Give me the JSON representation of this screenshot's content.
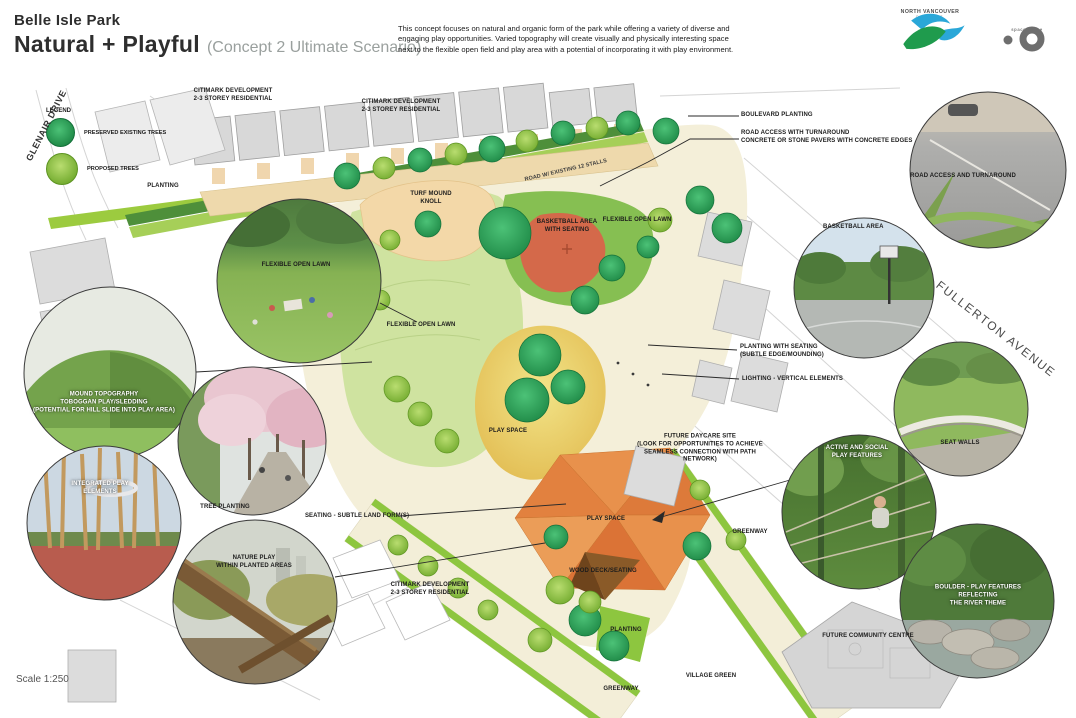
{
  "header": {
    "park_name": "Belle Isle Park",
    "concept_title": "Natural + Playful",
    "concept_subtitle": "(Concept 2 Ultimate Scenario)",
    "description": "This concept focuses on natural and organic form of the park while offering a variety of diverse and engaging play opportunities.  Varied topography will create visually and physically interesting space next to the flexible open field and play area with a potential of incorporating it with play environment.",
    "logo_nv": {
      "line1": "NORTH VANCOUVER",
      "line2": "DISTRICT"
    },
    "logo_firm": {
      "text": "space2place"
    }
  },
  "legend": {
    "title": "LEGEND",
    "items": [
      {
        "label": "PRESERVED EXISTING TREES",
        "color": "#2fa360"
      },
      {
        "label": "PROPOSED TREES",
        "color": "#8dc63f"
      }
    ]
  },
  "streets": {
    "glenair": "GLENAIR DRIVE",
    "fullerton": "FULLERTON AVENUE"
  },
  "scale_label": "Scale 1:250",
  "map_labels": [
    {
      "text": "CITIMARK DEVELOPMENT\n2-3 STOREY RESIDENTIAL"
    },
    {
      "text": "CITIMARK DEVELOPMENT\n2-3 STOREY RESIDENTIAL"
    },
    {
      "text": "PLANTING"
    },
    {
      "text": "TURF MOUND\nKNOLL"
    },
    {
      "text": "ROAD W/ EXISTING 12 STALLS"
    },
    {
      "text": "BASKETBALL AREA\nWITH SEATING"
    },
    {
      "text": "FLEXIBLE OPEN LAWN"
    },
    {
      "text": "FLEXIBLE OPEN LAWN"
    },
    {
      "text": "PLAY SPACE"
    },
    {
      "text": "SEATING - SUBTLE LAND FORM(S)"
    },
    {
      "text": "PLAY SPACE"
    },
    {
      "text": "WOOD DECK/SEATING"
    },
    {
      "text": "GREENWAY"
    },
    {
      "text": "CITIMARK DEVELOPMENT\n2-3 STOREY RESIDENTIAL"
    },
    {
      "text": "PLANTING"
    },
    {
      "text": "VILLAGE GREEN"
    },
    {
      "text": "GREENWAY"
    },
    {
      "text": "FUTURE COMMUNITY CENTRE"
    }
  ],
  "annotations": [
    {
      "text": "BOULEVARD PLANTING"
    },
    {
      "text": "ROAD ACCESS WITH TURNAROUND\nCONCRETE OR STONE PAVERS WITH CONCRETE EDGES"
    },
    {
      "text": "PLANTING WITH SEATING\n(SUBTLE EDGE/MOUNDING)"
    },
    {
      "text": "LIGHTING - VERTICAL ELEMENTS"
    },
    {
      "text": "FUTURE DAYCARE SITE\n(LOOK FOR OPPORTUNITIES TO ACHIEVE\nSEAMLESS CONNECTION WITH PATH\nNETWORK)"
    },
    {
      "text": "BASKETBALL AREA"
    }
  ],
  "photo_captions": [
    {
      "text": "FLEXIBLE OPEN LAWN"
    },
    {
      "text": "MOUND TOPOGRAPHY\nTOBOGGAN PLAY/SLEDDING\n(POTENTIAL FOR HILL SLIDE INTO PLAY AREA)"
    },
    {
      "text": "TREE PLANTING"
    },
    {
      "text": "INTEGRATED PLAY\nELEMENTS"
    },
    {
      "text": "NATURE PLAY\nWITHIN PLANTED AREAS"
    },
    {
      "text": "ROAD ACCESS AND TURNAROUND"
    },
    {
      "text": "SEAT WALLS"
    },
    {
      "text": "ACTIVE AND SOCIAL\nPLAY FEATURES"
    },
    {
      "text": "BOULDER - PLAY FEATURES\nREFLECTING\nTHE RIVER THEME"
    }
  ],
  "colors": {
    "preserved_tree": "#2fa360",
    "proposed_tree": "#8dc63f",
    "lawn": "#cfe3a0",
    "play_mound_yellow": "#ecd96e",
    "play_space_orange": "#e8914c",
    "basketball_red": "#d4694a",
    "road_tan": "#eed9ac",
    "greenway_green": "#8dc63f",
    "building_gray": "#d9d9d9"
  }
}
